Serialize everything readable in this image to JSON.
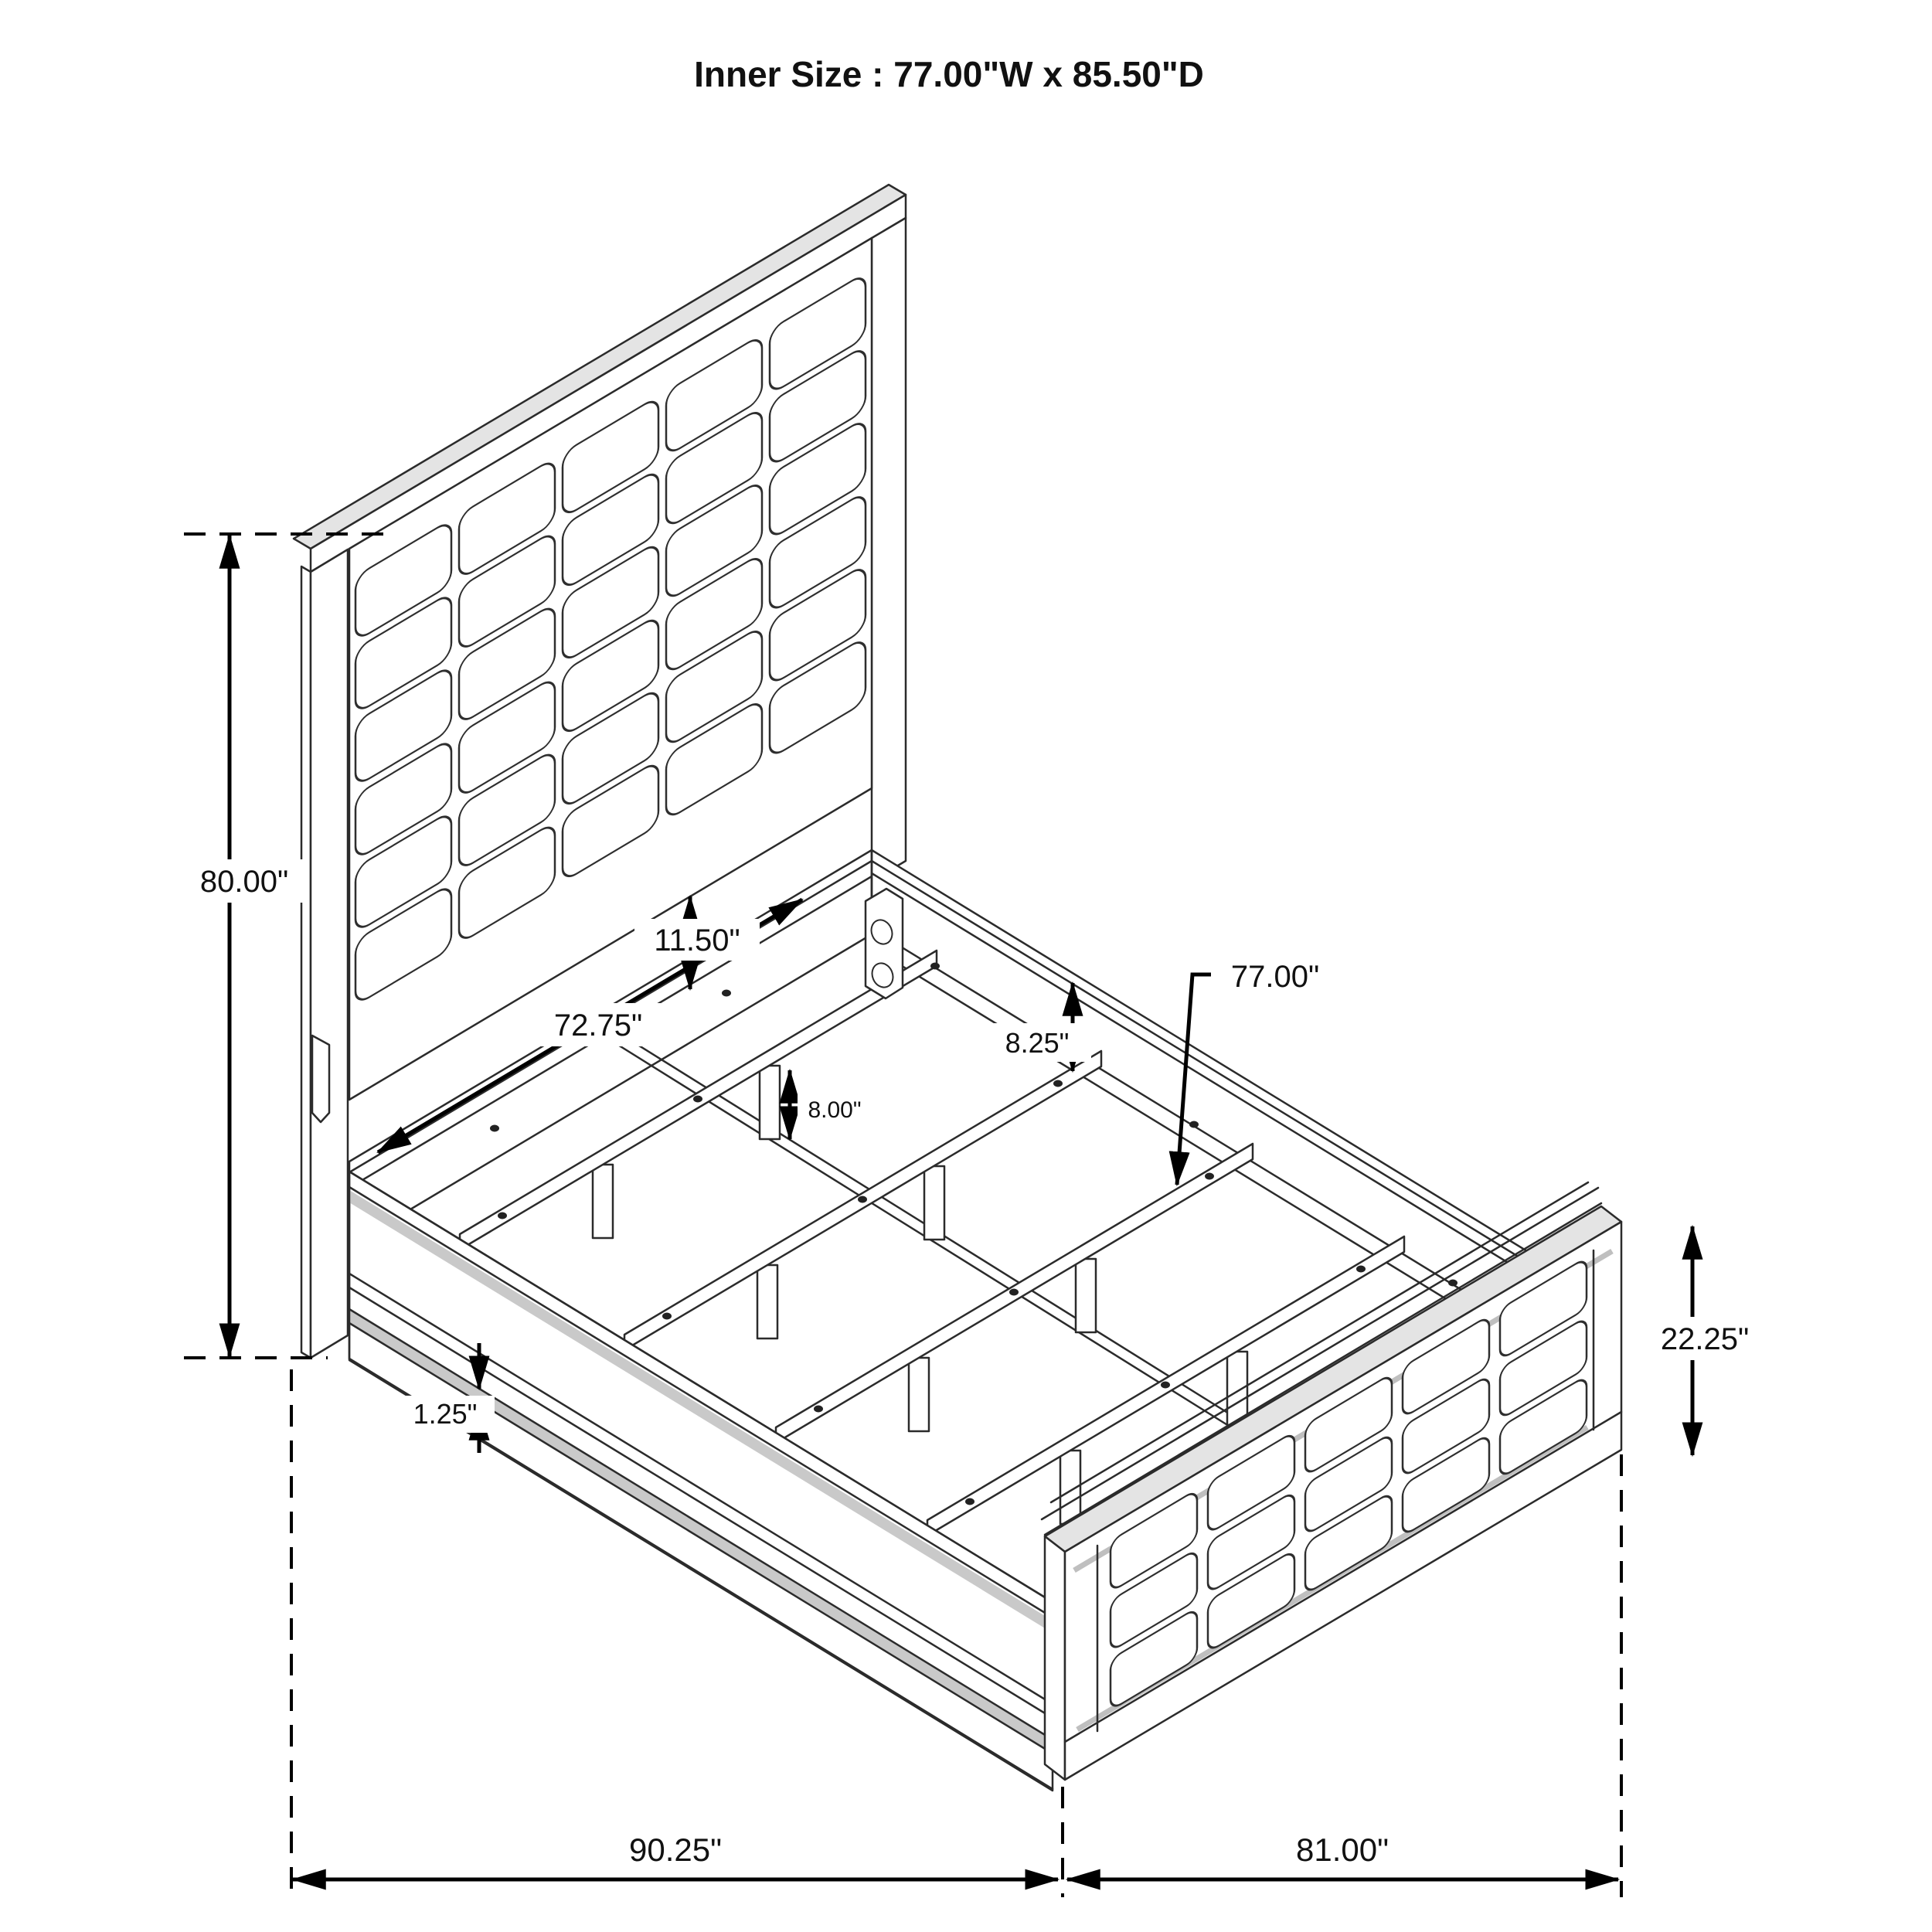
{
  "title": "Inner Size : 77.00\"W x 85.50\"D",
  "dims": {
    "headboard_height": "80.00\"",
    "headboard_width": "72.75\"",
    "headboard_clearance": "11.50\"",
    "support_leg_height": "8.00\"",
    "side_rail_height": "8.25\"",
    "slat_length": "77.00\"",
    "footboard_height": "22.25\"",
    "overall_depth": "90.25\"",
    "overall_width": "81.00\""
  }
}
